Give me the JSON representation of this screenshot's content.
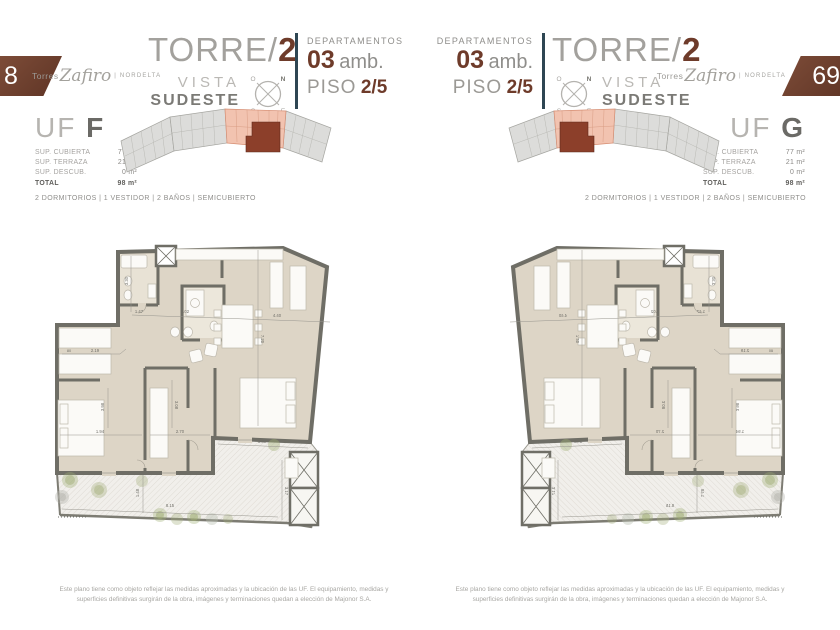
{
  "brand": {
    "torres": "Torres",
    "name": "Zafiro",
    "nordelta": "| NORDELTA"
  },
  "page_numbers": {
    "left": "8",
    "right": "69"
  },
  "tower": {
    "prefix": "TORRE/",
    "number": "2",
    "vista": "VISTA",
    "orientation": "SUDESTE"
  },
  "departamentos": {
    "label": "DEPARTAMENTOS",
    "number": "03",
    "amb": "amb.",
    "piso_label": "PISO",
    "piso_value": "2/5"
  },
  "compass": {
    "nw": "O",
    "ne": "N",
    "sw": "S",
    "se": "E"
  },
  "units": {
    "f": {
      "uf": "UF",
      "letter": "F",
      "rows": [
        {
          "label": "SUP. CUBIERTA",
          "value": "77 m²"
        },
        {
          "label": "SUP. TERRAZA",
          "value": "21 m²"
        },
        {
          "label": "SUP. DESCUB.",
          "value": "0 m²"
        }
      ],
      "total_label": "TOTAL",
      "total_value": "98 m²",
      "features": "2 DORMITORIOS | 1 VESTIDOR | 2 BAÑOS | SEMICUBIERTO"
    },
    "g": {
      "uf": "UF",
      "letter": "G",
      "rows": [
        {
          "label": "SUP. CUBIERTA",
          "value": "77 m²"
        },
        {
          "label": "SUP. TERRAZA",
          "value": "21 m²"
        },
        {
          "label": "SUP. DESCUB.",
          "value": "0 m²"
        }
      ],
      "total_label": "TOTAL",
      "total_value": "98 m²",
      "features": "2 DORMITORIOS | 1 VESTIDOR | 2 BAÑOS | SEMICUBIERTO"
    }
  },
  "plan": {
    "dims": [
      "3.30",
      "1.47",
      "2.02",
      "4.40",
      "7.20",
      "80",
      "2.19",
      "3.08",
      "1.94",
      "2.70",
      "3.80",
      "1.48",
      "8.15",
      "3.17",
      "3.98"
    ]
  },
  "footer": {
    "disclaimer": "Este plano tiene como objeto reflejar las medidas aproximadas y la ubicación de las UF. El equipamiento, medidas y superficies definitivas surgirán de la obra, imágenes y terminaciones quedan a elección de Majonor S.A."
  },
  "colors": {
    "accent": "#6e3b2a",
    "keyplan_highlight": "#f2c3b0",
    "keyplan_unit": "#8c3f2a",
    "floor": "#ddd5c6",
    "wall": "#6f6e66"
  }
}
